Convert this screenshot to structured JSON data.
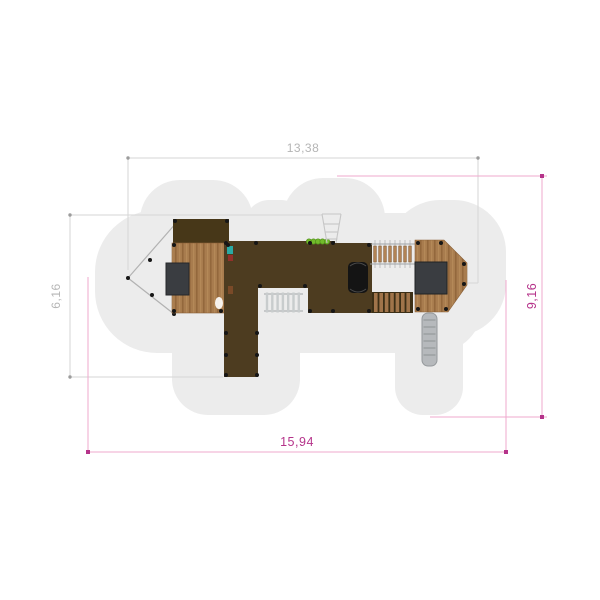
{
  "drawing": {
    "title": "playground-structure-top-view",
    "dimensions": {
      "equipment_width": {
        "label": "13,38"
      },
      "equipment_depth": {
        "label": "6,16"
      },
      "safety_zone_width": {
        "label": "15,94"
      },
      "safety_zone_depth": {
        "label": "9,16"
      }
    },
    "colors": {
      "background": "#ffffff",
      "safety_zone": "#ececec",
      "equipment_dim_line": "#d6d6d6",
      "equipment_dim_text": "#b5b5b5",
      "safety_dim_line": "#efa9ce",
      "safety_dim_accent": "#b5338a",
      "deck_dark": "#4d3c20",
      "roof": "#473718",
      "wood": "#a87c4e",
      "panel": "#3a3d41",
      "slide": "#b6b9bc",
      "tube": "#141414",
      "caterpillar": "#72bc2b"
    }
  }
}
